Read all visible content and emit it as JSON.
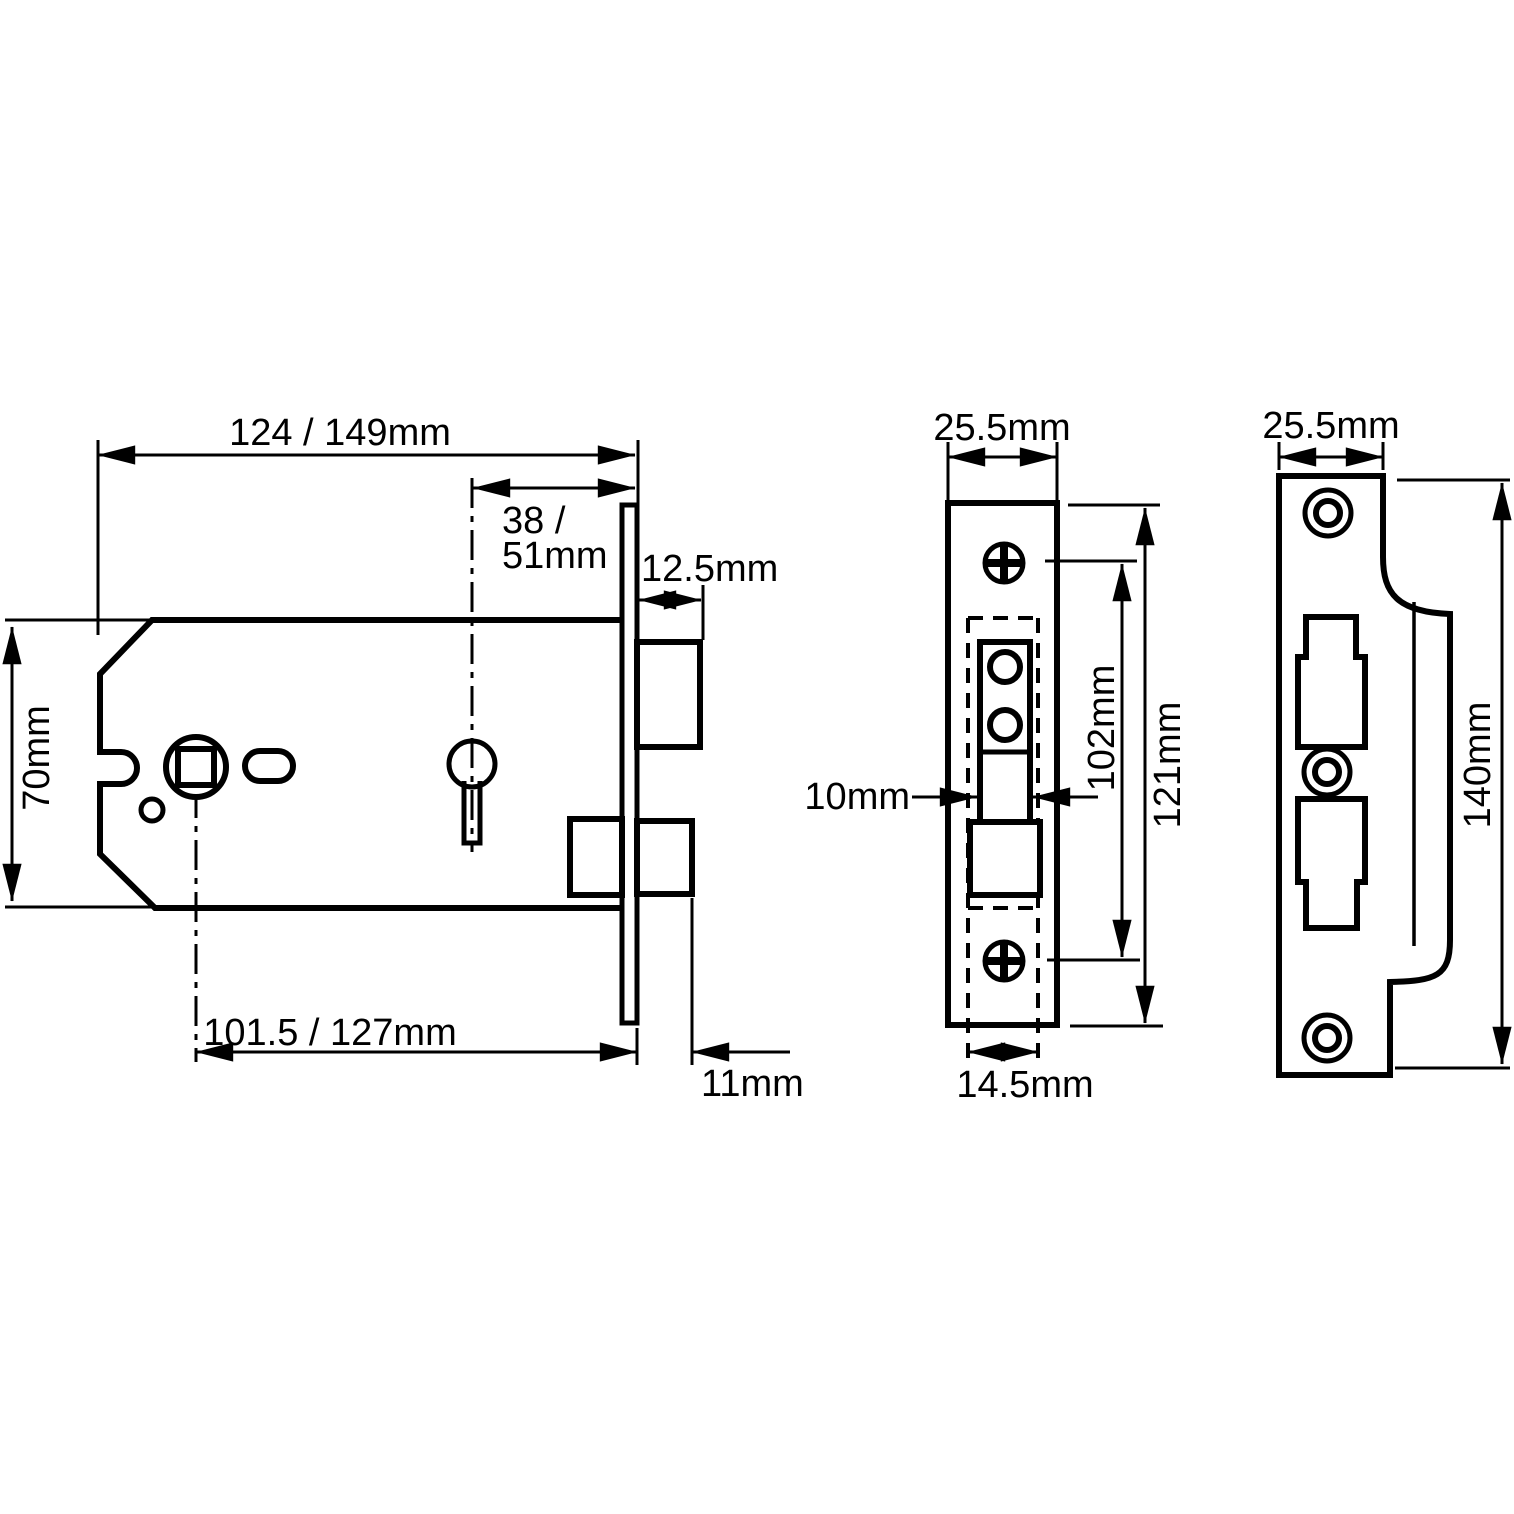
{
  "figure": {
    "ink_color": "#000000",
    "background_color": "#ffffff",
    "views": {
      "side": {
        "dims": {
          "case_length": "124 / 149mm",
          "backset_line1": "38 /",
          "backset_line2": "51mm",
          "latch_projection": "12.5mm",
          "case_height": "70mm",
          "centres": "101.5 / 127mm",
          "deadbolt_projection": "11mm"
        }
      },
      "front": {
        "dims": {
          "faceplate_width": "25.5mm",
          "follower_width": "10mm",
          "screw_centres": "102mm",
          "faceplate_height": "121mm",
          "case_depth": "14.5mm"
        }
      },
      "strike": {
        "dims": {
          "plate_width": "25.5mm",
          "plate_height": "140mm"
        }
      }
    }
  }
}
